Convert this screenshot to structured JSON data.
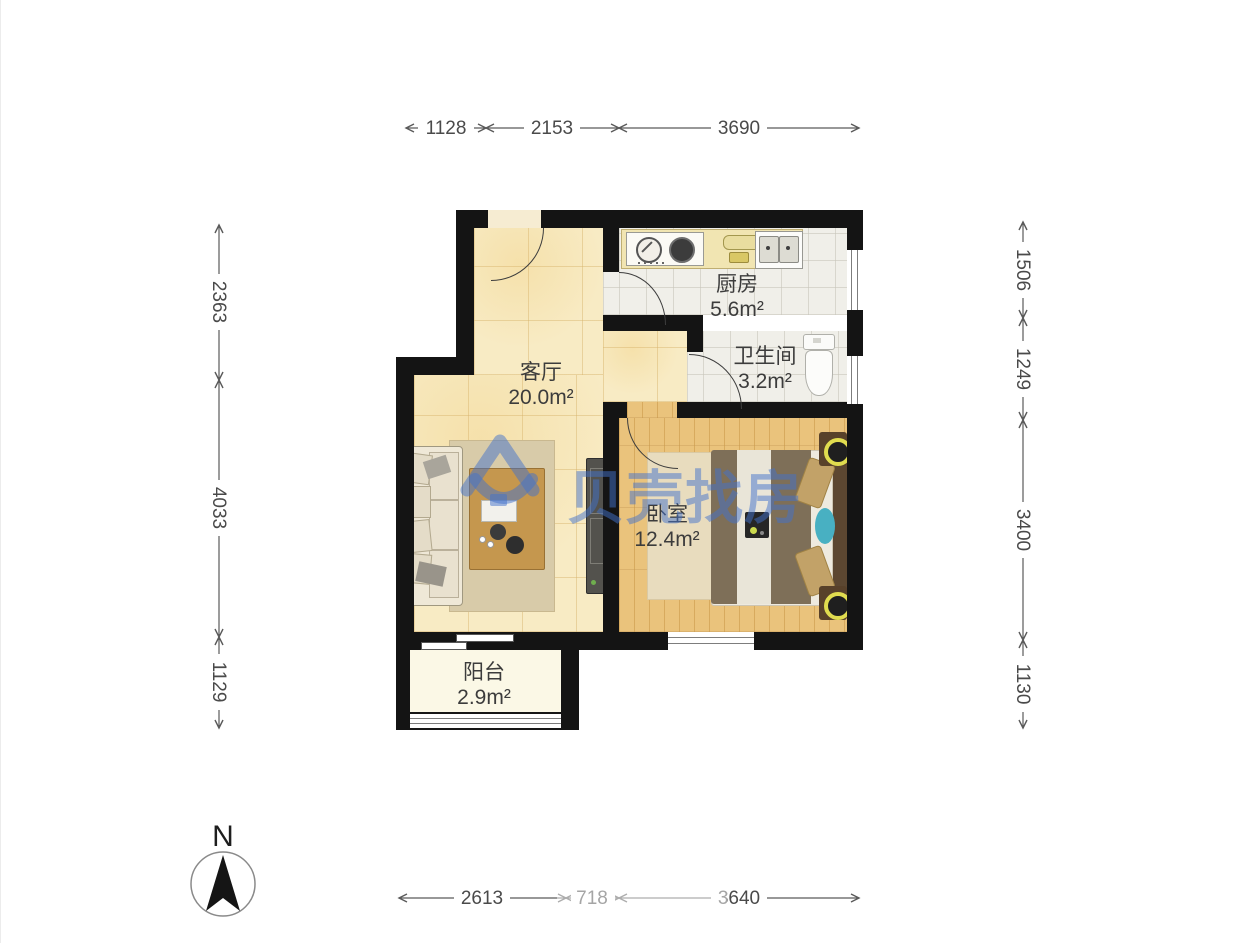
{
  "page": {
    "type": "floor-plan"
  },
  "watermark": {
    "text": "贝壳找房",
    "color": "#4272cc"
  },
  "compass": {
    "label": "N"
  },
  "rooms": {
    "living": {
      "name": "客厅",
      "area": "20.0m²"
    },
    "kitchen": {
      "name": "厨房",
      "area": "5.6m²"
    },
    "bathroom": {
      "name": "卫生间",
      "area": "3.2m²"
    },
    "bedroom": {
      "name": "卧室",
      "area": "12.4m²"
    },
    "balcony": {
      "name": "阳台",
      "area": "2.9m²"
    }
  },
  "dimensions": {
    "top": {
      "d1": "1128",
      "d2": "2153",
      "d3": "3690"
    },
    "left": {
      "d1": "2363",
      "d2": "4033",
      "d3": "1129"
    },
    "right": {
      "d1": "1506",
      "d2": "1249",
      "d3": "3400",
      "d4": "1130"
    },
    "bottom": {
      "d1": "2613",
      "d2": "718",
      "d3": "3640"
    }
  },
  "colors": {
    "wall": "#141414",
    "dimension_text": "#4a4a4a",
    "watermark_blue": "#4272cc"
  }
}
